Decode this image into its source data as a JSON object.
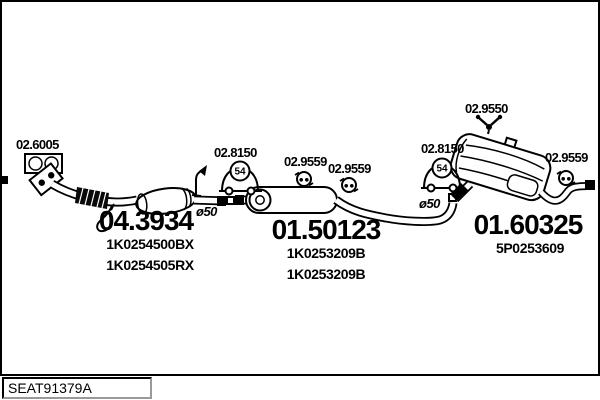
{
  "colors": {
    "background": "#ffffff",
    "line": "#000000"
  },
  "footer": {
    "drawing_code": "SEAT91379A"
  },
  "diagram": {
    "assemblies": [
      {
        "name": "front-pipe-with-catalyst",
        "part_number": "04.3934",
        "oe_numbers": [
          "1K0254500BX",
          "1K0254505RX"
        ],
        "outlet_diameter": "ø50"
      },
      {
        "name": "middle-silencer",
        "part_number": "01.50123",
        "oe_numbers": [
          "1K0253209B",
          "1K0253209B"
        ],
        "outlet_diameter": "ø50"
      },
      {
        "name": "rear-silencer",
        "part_number": "01.60325",
        "oe_numbers": [
          "5P0253609"
        ]
      }
    ],
    "fittings": {
      "gasket": {
        "label": "02.6005",
        "icon": "gasket-icon"
      },
      "mount_front": {
        "label": "02.8150",
        "badge": "54",
        "icon": "rubber-mount-icon"
      },
      "mount_rear": {
        "label": "02.8150",
        "badge": "54",
        "icon": "rubber-mount-icon"
      },
      "hanger_mid_1": {
        "label": "02.9559",
        "icon": "rubber-hanger-icon"
      },
      "hanger_mid_2": {
        "label": "02.9559",
        "icon": "rubber-hanger-icon"
      },
      "hanger_rear_top": {
        "label": "02.9550",
        "icon": "y-hanger-icon"
      },
      "hanger_tail": {
        "label": "02.9559",
        "icon": "rubber-hanger-icon"
      }
    }
  }
}
